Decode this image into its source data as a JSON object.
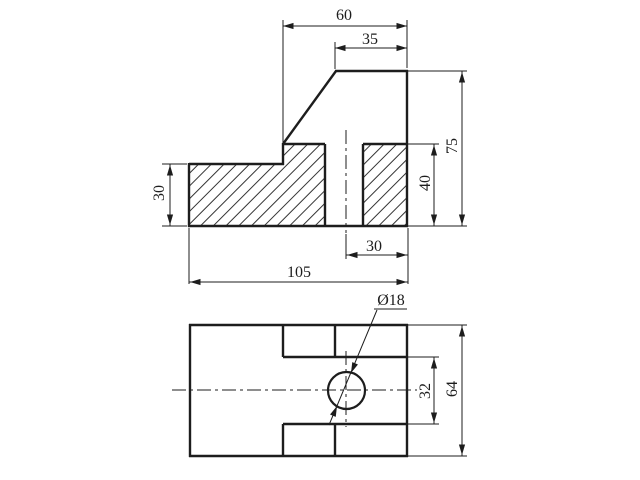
{
  "meta": {
    "description": "Two-view orthographic engineering drawing of an L-shaped block with through hole",
    "views": [
      "sectioned front view",
      "plan view"
    ]
  },
  "colors": {
    "background": "#ffffff",
    "ink": "#1d1d1d"
  },
  "drawing": {
    "labels": [
      {
        "id": "dim-60",
        "text": "60",
        "x": 344,
        "y": 14,
        "rotate": 0
      },
      {
        "id": "dim-35",
        "text": "35",
        "x": 370,
        "y": 38,
        "rotate": 0
      },
      {
        "id": "dim-75",
        "text": "75",
        "x": 451,
        "y": 146,
        "rotate": -90
      },
      {
        "id": "dim-40",
        "text": "40",
        "x": 424,
        "y": 183,
        "rotate": -90
      },
      {
        "id": "dim-30-left",
        "text": "30",
        "x": 158,
        "y": 193,
        "rotate": -90
      },
      {
        "id": "dim-30-bottom",
        "text": "30",
        "x": 374,
        "y": 245,
        "rotate": 0
      },
      {
        "id": "dim-105",
        "text": "105",
        "x": 299,
        "y": 271,
        "rotate": 0
      },
      {
        "id": "dim-dia-18",
        "text": "Ø18",
        "x": 391,
        "y": 299,
        "rotate": 0
      },
      {
        "id": "dim-32",
        "text": "32",
        "x": 424,
        "y": 391,
        "rotate": -90
      },
      {
        "id": "dim-64",
        "text": "64",
        "x": 451,
        "y": 389,
        "rotate": -90
      }
    ],
    "thick_lines": [
      [
        189,
        164,
        284,
        164
      ],
      [
        189,
        163,
        189,
        227
      ],
      [
        188,
        226,
        408,
        226
      ],
      [
        283,
        143,
        283,
        165
      ],
      [
        283,
        144,
        336,
        71
      ],
      [
        335,
        71,
        408,
        71
      ],
      [
        407,
        70,
        407,
        227
      ],
      [
        283,
        144,
        325,
        144
      ],
      [
        363,
        144,
        408,
        144
      ],
      [
        325,
        144,
        325,
        226
      ],
      [
        363,
        144,
        363,
        226
      ],
      [
        189,
        325,
        408,
        325
      ],
      [
        190,
        324,
        190,
        457
      ],
      [
        407,
        324,
        407,
        457
      ],
      [
        189,
        456,
        408,
        456
      ],
      [
        283,
        357,
        408,
        357
      ],
      [
        283,
        424,
        408,
        424
      ],
      [
        283,
        325,
        283,
        357
      ],
      [
        335,
        325,
        335,
        357
      ],
      [
        283,
        424,
        283,
        456
      ],
      [
        335,
        424,
        335,
        456
      ]
    ],
    "thin_lines": [
      [
        283,
        20,
        283,
        143
      ],
      [
        407,
        20,
        407,
        68
      ],
      [
        283,
        26,
        407,
        26
      ],
      [
        335,
        42,
        335,
        69
      ],
      [
        335,
        48,
        407,
        48
      ],
      [
        408,
        71,
        467,
        71
      ],
      [
        408,
        226,
        467,
        226
      ],
      [
        462,
        71,
        462,
        226
      ],
      [
        408,
        144,
        439,
        144
      ],
      [
        434,
        144,
        434,
        226
      ],
      [
        162,
        164,
        187,
        164
      ],
      [
        162,
        226,
        187,
        226
      ],
      [
        170,
        164,
        170,
        226
      ],
      [
        346,
        234,
        346,
        259
      ],
      [
        408,
        228,
        408,
        284
      ],
      [
        346,
        255,
        408,
        255
      ],
      [
        189,
        228,
        189,
        284
      ],
      [
        189,
        282,
        408,
        282
      ],
      [
        408,
        325,
        467,
        325
      ],
      [
        408,
        456,
        467,
        456
      ],
      [
        462,
        325,
        462,
        456
      ],
      [
        408,
        357,
        439,
        357
      ],
      [
        408,
        424,
        439,
        424
      ],
      [
        434,
        357,
        434,
        424
      ],
      [
        329,
        425,
        377,
        310
      ],
      [
        374,
        309,
        407,
        309
      ]
    ],
    "centerlines": [
      [
        346,
        130,
        346,
        233
      ],
      [
        172,
        390,
        417,
        390
      ],
      [
        346,
        351,
        346,
        427
      ]
    ],
    "hatch_polygons": [
      [
        [
          189,
          164
        ],
        [
          283,
          164
        ],
        [
          283,
          144
        ],
        [
          325,
          144
        ],
        [
          325,
          226
        ],
        [
          189,
          226
        ]
      ],
      [
        [
          363,
          144
        ],
        [
          407,
          144
        ],
        [
          407,
          226
        ],
        [
          363,
          226
        ]
      ]
    ],
    "circles": [
      {
        "id": "hole",
        "cx": 346.5,
        "cy": 390.5,
        "r": 18.5
      }
    ],
    "arrows": [
      {
        "x": 283,
        "y": 26,
        "angle": 180
      },
      {
        "x": 407,
        "y": 26,
        "angle": 0
      },
      {
        "x": 335,
        "y": 48,
        "angle": 180
      },
      {
        "x": 407,
        "y": 48,
        "angle": 0
      },
      {
        "x": 462,
        "y": 72,
        "angle": 270
      },
      {
        "x": 462,
        "y": 225,
        "angle": 90
      },
      {
        "x": 434,
        "y": 145,
        "angle": 270
      },
      {
        "x": 434,
        "y": 225,
        "angle": 90
      },
      {
        "x": 170,
        "y": 165,
        "angle": 270
      },
      {
        "x": 170,
        "y": 225,
        "angle": 90
      },
      {
        "x": 347,
        "y": 255,
        "angle": 180
      },
      {
        "x": 407,
        "y": 255,
        "angle": 0
      },
      {
        "x": 190,
        "y": 282,
        "angle": 180
      },
      {
        "x": 407,
        "y": 282,
        "angle": 0
      },
      {
        "x": 434,
        "y": 358,
        "angle": 270
      },
      {
        "x": 434,
        "y": 423,
        "angle": 90
      },
      {
        "x": 462,
        "y": 326,
        "angle": 270
      },
      {
        "x": 462,
        "y": 455,
        "angle": 90
      },
      {
        "x": 351,
        "y": 373,
        "angle": 113
      },
      {
        "x": 337,
        "y": 406,
        "angle": -67
      }
    ]
  }
}
